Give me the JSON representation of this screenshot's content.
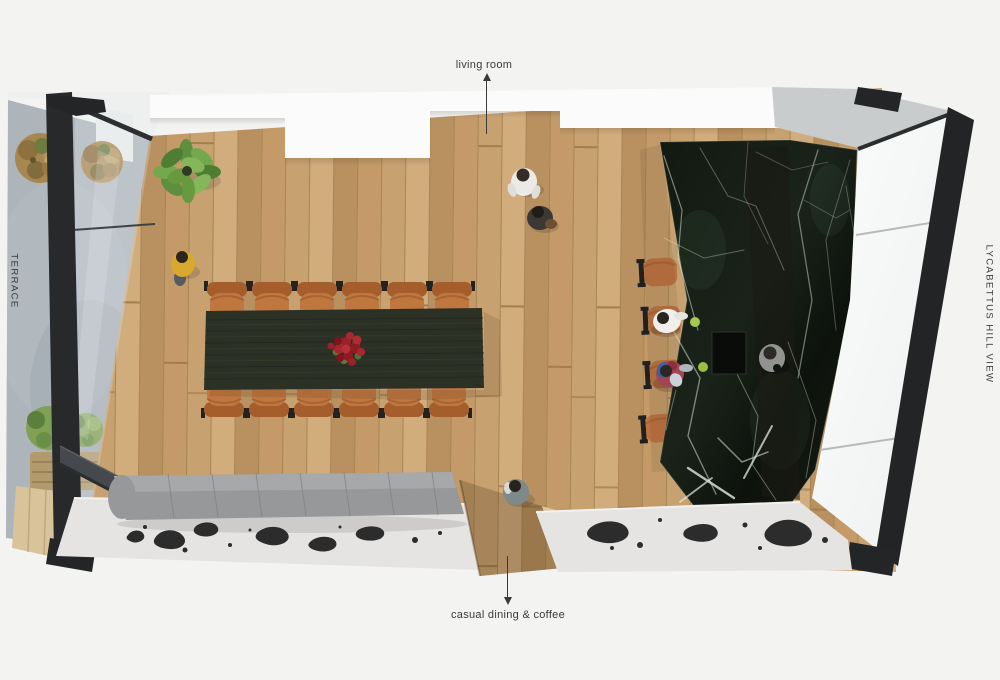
{
  "labels": {
    "top": "living room",
    "bottom": "casual dining & coffee",
    "left": "TERRACE",
    "right": "LYCABETTUS HILL VIEW"
  },
  "scene": {
    "type": "top-view architectural rendering",
    "areas": [
      "terrace",
      "dining area",
      "kitchen island",
      "bench seating",
      "walkway to living room"
    ],
    "dining_chairs_count": 12,
    "bar_stools_count": 4,
    "people_count": 7,
    "plant": "potted green plant",
    "centerpiece": "red roses on dining table",
    "floor_rugs_with_ink_pattern": 2
  },
  "colors": {
    "background": "#f3f3f2",
    "wood_floor": "#c9a06b",
    "walkway_wood": "#a97f4e",
    "marble_base": "#141b13",
    "marble_vein": "#dfebe0",
    "table": "#2c3126",
    "chair_leather": "#c0773f",
    "stool_leather": "#bd7240",
    "bench_gray": "#96989a",
    "slab_floor": "#e5e4e2",
    "ink_splotch": "#2c2c2c",
    "window_frame": "#232527",
    "terrace_stone": "#adb5bb",
    "bush_orange": "#a8854c",
    "bush_green": "#7fa055",
    "roses": "#9c2027",
    "label_text": "#3a3a3a"
  }
}
